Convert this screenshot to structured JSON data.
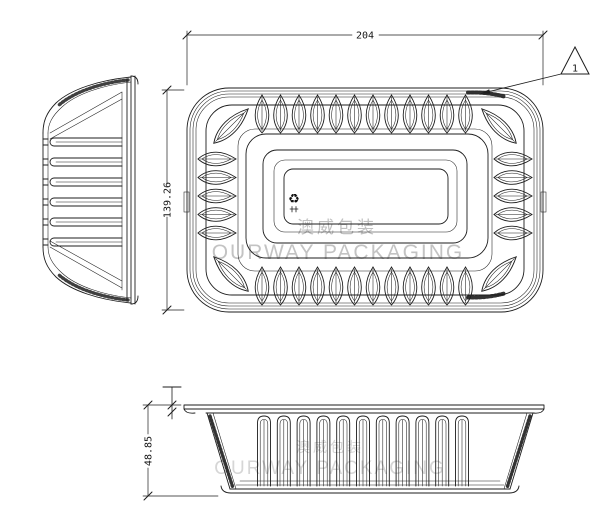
{
  "drawing": {
    "dimensions": {
      "width": "204",
      "depth": "139.26",
      "height": "48.85"
    },
    "revision_marker": "1",
    "watermark": {
      "chinese": "澳威包装",
      "english": "OURWAY PACKAGING"
    },
    "icons": {
      "recycling": "♻"
    },
    "colors": {
      "line": "#1d1d1d",
      "watermark_gray": "#c2c2c2",
      "watermark_faint": "#d6d6d6",
      "background": "#ffffff"
    }
  }
}
